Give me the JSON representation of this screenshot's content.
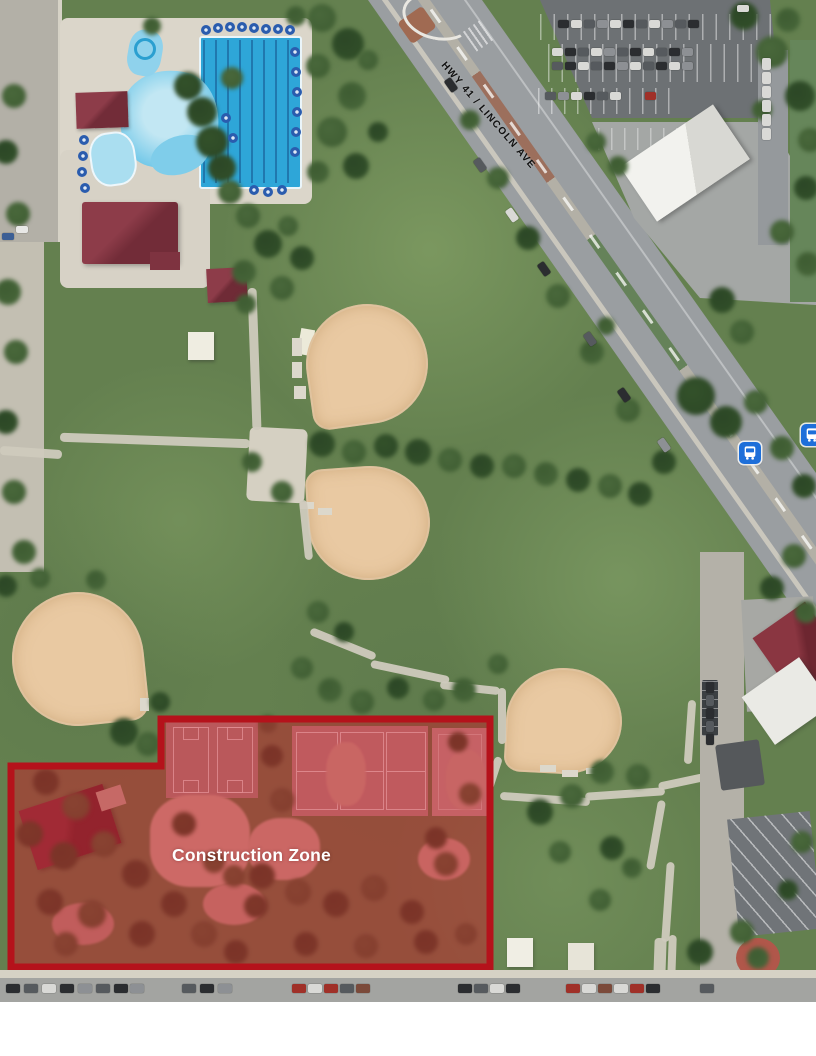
{
  "page": {
    "background": "#ffffff",
    "description": "Aerial photo of a park with pool, ball fields and a highlighted construction zone"
  },
  "road": {
    "label": "HWY 41 / LINCOLN AVE"
  },
  "construction_zone": {
    "label": "Construction Zone",
    "fill_color": "#c3202a",
    "fill_opacity": 0.52,
    "border_color": "#b5121b"
  },
  "transit": {
    "bus_stop_icon_color": "#1e6fd9",
    "bus_stop_count": 2
  }
}
